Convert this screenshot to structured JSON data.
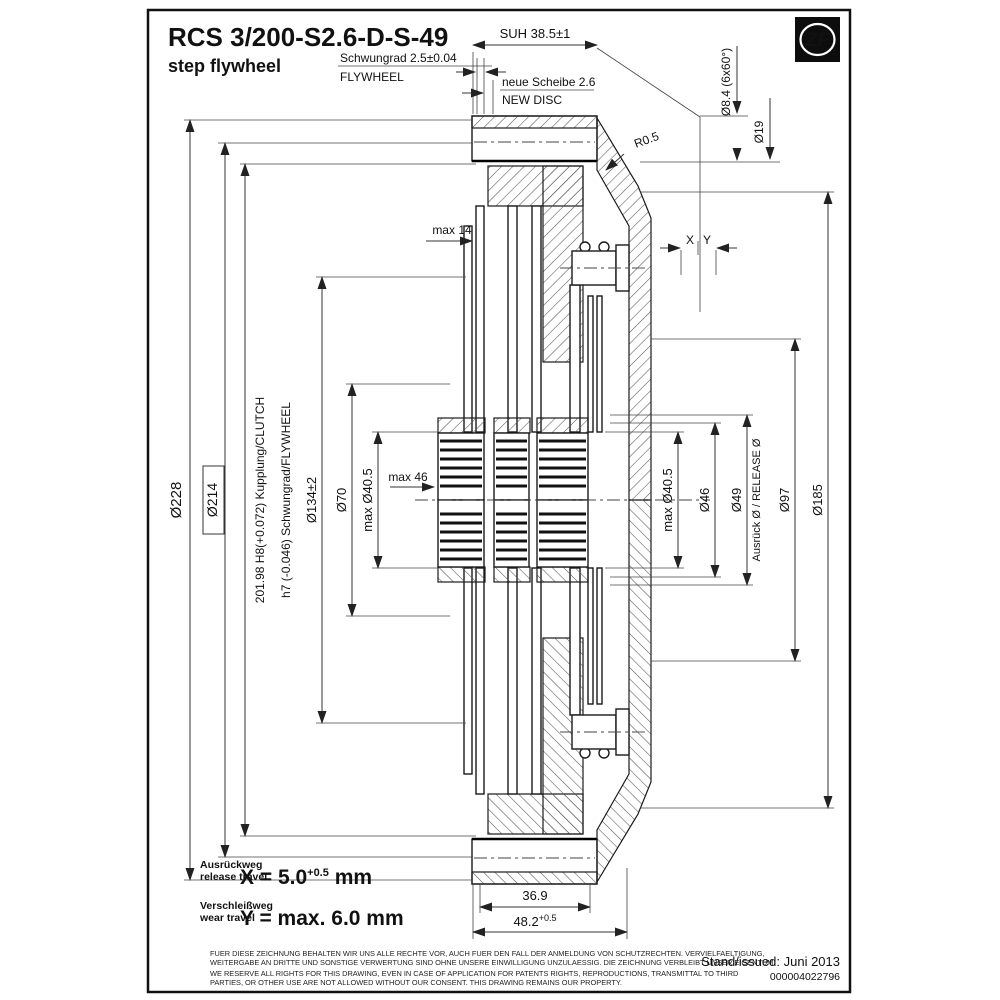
{
  "title": {
    "model": "RCS 3/200-S2.6-D-S-49",
    "subtitle": "step flywheel"
  },
  "logo": {
    "brand": "ZF"
  },
  "top": {
    "suh": "SUH 38.5±1",
    "flywheel_de": "Schwungrad 2.5±0.04",
    "flywheel_en": "FLYWHEEL",
    "disc_de": "neue Scheibe 2.6",
    "disc_en": "NEW DISC",
    "radius": "R0.5",
    "bolt_hole": "Ø8.4 (6x60°)",
    "counterbore": "Ø19",
    "x": "X",
    "y": "Y"
  },
  "left": {
    "d228": "Ø228",
    "d214": "Ø214",
    "clutch_fit": "201.98 H8(+0.072)  Kupplung/CLUTCH",
    "flywheel_fit": "h7 (-0.046)  Schwungrad/FLYWHEEL",
    "d134": "Ø134±2",
    "d70": "Ø70",
    "d405": "max Ø40.5",
    "max46": "max 46",
    "max14": "max 14"
  },
  "right": {
    "d405": "max Ø40.5",
    "d46": "Ø46",
    "d49": "Ø49",
    "release": "Ausrück Ø  /  RELEASE Ø",
    "d97": "Ø97",
    "d185": "Ø185"
  },
  "bottom": {
    "w369": "36.9",
    "w482": "48.2",
    "w482_tol": "+0.5"
  },
  "travel": {
    "release_de": "Ausrückweg",
    "release_en": "release travel",
    "x_formula": "X = 5.0",
    "x_tol": "+0.5",
    "x_unit": " mm",
    "wear_de": "Verschleißweg",
    "wear_en": "wear travel",
    "y_formula": "Y = max. 6.0 mm"
  },
  "legal": {
    "de1": "FUER DIESE ZEICHNUNG BEHALTEN WIR UNS ALLE RECHTE VOR, AUCH FUER DEN FALL DER ANMELDUNG VON SCHUTZRECHTEN. VERVIELFAELTIGUNG,",
    "de2": "WEITERGABE AN DRITTE UND SONSTIGE VERWERTUNG SIND OHNE UNSERE EINWILLIGUNG UNZULAESSIG. DIE ZEICHNUNG VERBLEIBT UNSER EIGENTUM.",
    "en1": "WE RESERVE ALL RIGHTS FOR THIS DRAWING, EVEN IN CASE OF APPLICATION FOR PATENTS RIGHTS, REPRODUCTIONS, TRANSMITTAL TO THIRD",
    "en2": "PARTIES, OR OTHER USE ARE NOT ALLOWED WITHOUT OUR CONSENT. THIS DRAWING REMAINS OUR PROPERTY."
  },
  "issue": {
    "stand": "Stand/issued: Juni 2013",
    "number": "000004022796"
  }
}
